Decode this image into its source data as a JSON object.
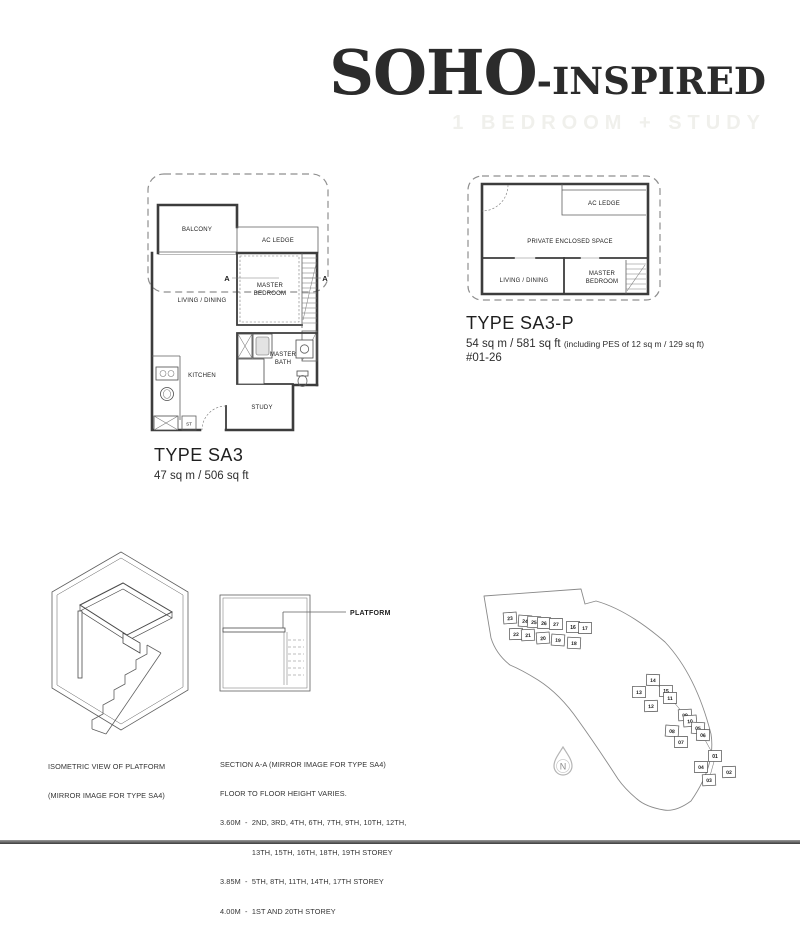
{
  "header": {
    "title_main": "SOHO",
    "title_rest": "-INSPIRED",
    "subtitle": "1 BEDROOM + STUDY"
  },
  "plan_sa3": {
    "labels": {
      "balcony": "BALCONY",
      "ac_ledge": "AC LEDGE",
      "living_dining": "LIVING / DINING",
      "master_line1": "MASTER",
      "master_line2": "BEDROOM",
      "kitchen": "KITCHEN",
      "bath_line1": "MASTER",
      "bath_line2": "BATH",
      "study": "STUDY",
      "store": "ST",
      "section_left": "A",
      "section_right": "A"
    },
    "type_label": "TYPE SA3",
    "area": "47 sq m / 506 sq ft"
  },
  "plan_sa3p": {
    "labels": {
      "ac_ledge": "AC LEDGE",
      "pes": "PRIVATE ENCLOSED SPACE",
      "living_dining": "LIVING / DINING",
      "master_line1": "MASTER",
      "master_line2": "BEDROOM"
    },
    "type_label": "TYPE SA3-P",
    "area": "54 sq m / 581 sq ft",
    "area_note": "(including PES of 12 sq m / 129 sq ft)",
    "unit_no": "#01-26"
  },
  "isometric": {
    "caption_line1": "ISOMETRIC VIEW OF PLATFORM",
    "caption_line2": "(MIRROR IMAGE FOR TYPE SA4)"
  },
  "section": {
    "platform_label": "PLATFORM",
    "caption_lines": [
      "SECTION A-A (MIRROR IMAGE FOR TYPE SA4)",
      "FLOOR TO FLOOR HEIGHT VARIES.",
      "3.60M  -  2ND, 3RD, 4TH, 6TH, 7TH, 9TH, 10TH, 12TH,",
      "               13TH, 15TH, 16TH, 18TH, 19TH STOREY",
      "3.85M  -  5TH, 8TH, 11TH, 14TH, 17TH STOREY",
      "4.00M  -  1ST AND 20TH STOREY"
    ]
  },
  "site_plan": {
    "north_label": "N",
    "blocks": [
      {
        "no": "23",
        "x": 32,
        "y": 38
      },
      {
        "no": "24",
        "x": 47,
        "y": 41
      },
      {
        "no": "25",
        "x": 56,
        "y": 42
      },
      {
        "no": "26",
        "x": 66,
        "y": 43
      },
      {
        "no": "27",
        "x": 78,
        "y": 44
      },
      {
        "no": "16",
        "x": 95,
        "y": 47
      },
      {
        "no": "17",
        "x": 107,
        "y": 48
      },
      {
        "no": "22",
        "x": 38,
        "y": 54
      },
      {
        "no": "21",
        "x": 50,
        "y": 55
      },
      {
        "no": "20",
        "x": 65,
        "y": 58
      },
      {
        "no": "19",
        "x": 80,
        "y": 60
      },
      {
        "no": "18",
        "x": 96,
        "y": 63
      },
      {
        "no": "14",
        "x": 175,
        "y": 100
      },
      {
        "no": "13",
        "x": 161,
        "y": 112
      },
      {
        "no": "15",
        "x": 188,
        "y": 111
      },
      {
        "no": "11",
        "x": 192,
        "y": 118
      },
      {
        "no": "12",
        "x": 173,
        "y": 126
      },
      {
        "no": "09",
        "x": 207,
        "y": 135
      },
      {
        "no": "10",
        "x": 212,
        "y": 141
      },
      {
        "no": "08",
        "x": 194,
        "y": 151
      },
      {
        "no": "05",
        "x": 220,
        "y": 148
      },
      {
        "no": "06",
        "x": 225,
        "y": 155
      },
      {
        "no": "07",
        "x": 203,
        "y": 162
      },
      {
        "no": "01",
        "x": 237,
        "y": 176
      },
      {
        "no": "04",
        "x": 223,
        "y": 187
      },
      {
        "no": "02",
        "x": 251,
        "y": 192
      },
      {
        "no": "03",
        "x": 231,
        "y": 200
      }
    ]
  }
}
